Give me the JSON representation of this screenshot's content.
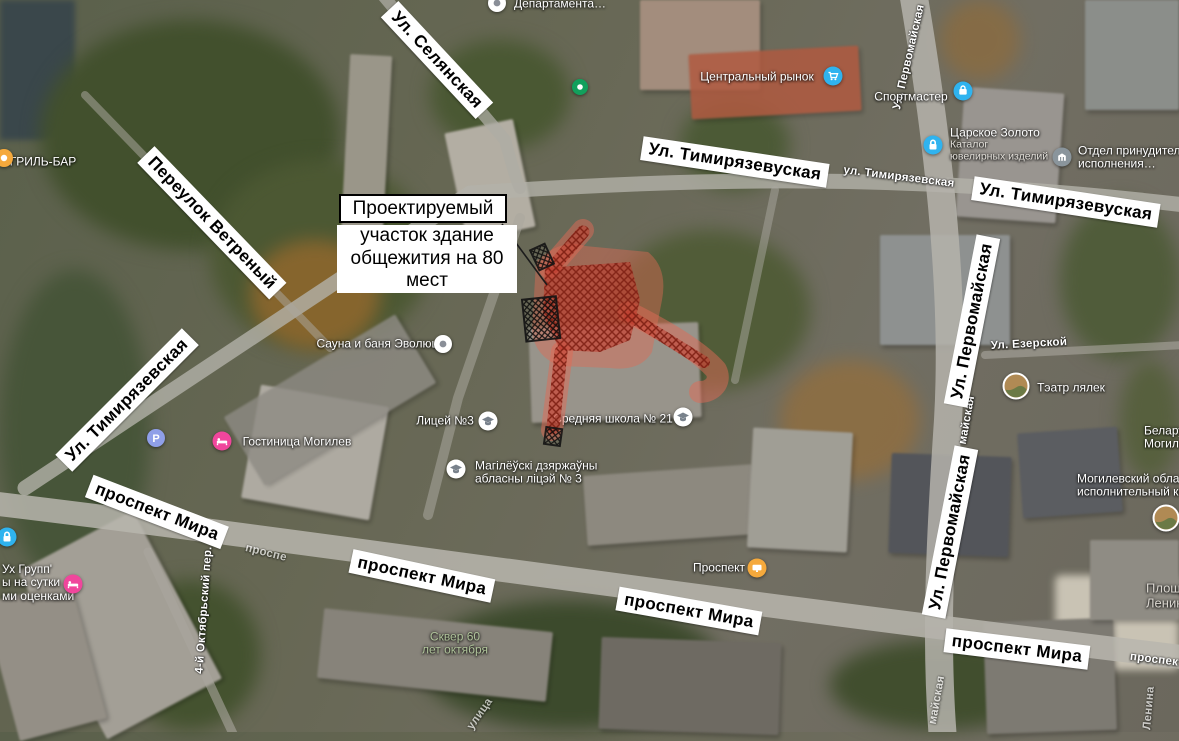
{
  "map": {
    "title": "Схема размещения проектируемого участка",
    "annotation": {
      "lines": [
        "Проектируемый",
        "участок здание",
        "общежития на 80",
        "мест"
      ]
    },
    "colors": {
      "highlight_red": "#c0392b",
      "highlight_halo": "#e06a55",
      "hatch_dark_red": "#7e1f12",
      "hatch_black": "#0d0d0d",
      "poi_blue": "#2fb3ef",
      "poi_pink": "#f0469c",
      "poi_orange": "#f5a93c",
      "poi_green": "#12a05c",
      "poi_gray": "#8a959c",
      "parking_lavender": "#8f9fe8",
      "park_text_green": "#b0c49b",
      "area_text_gray": "#dbd7d0"
    },
    "street_labels_big": [
      {
        "id": "selyanskaya",
        "text": "Ул. Селянская",
        "x": 437,
        "y": 60,
        "rot": 47
      },
      {
        "id": "timiryazevskaya-center",
        "text": "Ул. Тимирязевуская",
        "x": 735,
        "y": 162,
        "rot": 8.5
      },
      {
        "id": "timiryazevskaya-right",
        "text": "Ул. Тимирязевуская",
        "x": 1066,
        "y": 202,
        "rot": 8.5
      },
      {
        "id": "timiryazevskaya-left",
        "text": "Ул. Тимирязевская",
        "x": 127,
        "y": 400,
        "rot": -45
      },
      {
        "id": "pereulok-vetreny",
        "text": "Переулок Ветреный",
        "x": 212,
        "y": 223,
        "rot": 46
      },
      {
        "id": "pervomayskaya-upper",
        "text": "Ул. Первомайская",
        "x": 972,
        "y": 321,
        "rot": -79
      },
      {
        "id": "pervomayskaya-lower",
        "text": "Ул. Первомайская",
        "x": 950,
        "y": 532,
        "rot": -79
      },
      {
        "id": "prospekt-mira-1",
        "text": "проспект Мира",
        "x": 157,
        "y": 512,
        "rot": 21
      },
      {
        "id": "prospekt-mira-2",
        "text": "проспект Мира",
        "x": 422,
        "y": 576,
        "rot": 12
      },
      {
        "id": "prospekt-mira-3",
        "text": "проспект Мира",
        "x": 689,
        "y": 611,
        "rot": 10
      },
      {
        "id": "prospekt-mira-4",
        "text": "проспект Мира",
        "x": 1017,
        "y": 649,
        "rot": 7
      }
    ],
    "street_labels_small": [
      {
        "id": "timiryazevskaya-road",
        "text": "ул. Тимирязевская",
        "x": 899,
        "y": 177,
        "rot": 7
      },
      {
        "id": "pervomayskaya-road-top",
        "text": "Ул. Первомайская",
        "x": 909,
        "y": 57,
        "rot": -77
      },
      {
        "id": "pervomayskaya-road-mid",
        "text": "майская",
        "x": 967,
        "y": 420,
        "rot": -80
      },
      {
        "id": "pervomayskaya-road-bottom",
        "text": "майская",
        "x": 937,
        "y": 700,
        "rot": -80,
        "faint": true
      },
      {
        "id": "oktyabrsky-pereulok",
        "text": "4-й Октябрьский пер.",
        "x": 204,
        "y": 610,
        "rot": -86
      },
      {
        "id": "ezerskoy",
        "text": "Ул. Езерской",
        "x": 1029,
        "y": 344,
        "rot": -3
      },
      {
        "id": "prospekt-road-br",
        "text": "проспект",
        "x": 1157,
        "y": 660,
        "rot": 7
      },
      {
        "id": "lenina-road",
        "text": "Ленина",
        "x": 1149,
        "y": 708,
        "rot": -85,
        "faint": true
      },
      {
        "id": "ulitsa-road",
        "text": "улица",
        "x": 480,
        "y": 714,
        "rot": -55,
        "faint": true
      },
      {
        "id": "prospekt-road-left",
        "text": "проспе",
        "x": 266,
        "y": 553,
        "rot": 14,
        "faint": true
      }
    ],
    "pois": [
      {
        "id": "departamenta",
        "lines": [
          "Департамента…"
        ],
        "x": 560,
        "y": 4,
        "icon": {
          "type": "circle-white",
          "x": 497,
          "y": 3
        }
      },
      {
        "id": "grill-bar",
        "lines": [
          "ГРИЛЬ-БАР"
        ],
        "x": 43,
        "y": 162,
        "icon": {
          "type": "circle-orange",
          "x": 4,
          "y": 158
        }
      },
      {
        "id": "central-market",
        "lines": [
          "Центральный рынок"
        ],
        "x": 757,
        "y": 77,
        "icon": {
          "type": "cart-blue",
          "x": 833,
          "y": 76
        }
      },
      {
        "id": "sportmaster",
        "lines": [
          "Спортмастер"
        ],
        "x": 911,
        "y": 97,
        "icon": {
          "type": "bag-blue",
          "x": 963,
          "y": 91
        }
      },
      {
        "id": "tsarskoe-zoloto",
        "lines": [
          "Царское Золото",
          "Каталог",
          "ювелирных изделий"
        ],
        "x": 950,
        "y": 145,
        "align": "left",
        "sub_after": 0,
        "icon": {
          "type": "lock-blue",
          "x": 933,
          "y": 145
        }
      },
      {
        "id": "otdel-ispolneniya",
        "lines": [
          "Отдел принудитель",
          "исполнения…"
        ],
        "x": 1078,
        "y": 158,
        "align": "left",
        "icon": {
          "type": "building-gray",
          "x": 1062,
          "y": 157
        }
      },
      {
        "id": "sauna-evolution",
        "lines": [
          "Сауна и баня Эволюция"
        ],
        "x": 384,
        "y": 344,
        "icon": {
          "type": "circle-white",
          "x": 443,
          "y": 344
        }
      },
      {
        "id": "litsey-3",
        "lines": [
          "Лицей №3"
        ],
        "x": 445,
        "y": 421,
        "icon": {
          "type": "cap-white",
          "x": 488,
          "y": 421
        }
      },
      {
        "id": "school-21",
        "lines": [
          "Средняя школа № 21"
        ],
        "x": 613,
        "y": 419,
        "icon": {
          "type": "cap-white",
          "x": 683,
          "y": 417
        }
      },
      {
        "id": "oblast-lyceum",
        "lines": [
          "Магілёўскі дзяржаўны",
          "абласны ліцэй № 3"
        ],
        "x": 475,
        "y": 473,
        "align": "left",
        "icon": {
          "type": "cap-white",
          "x": 456,
          "y": 469
        }
      },
      {
        "id": "hotel-mogilev",
        "lines": [
          "Гостиница Могилев"
        ],
        "x": 297,
        "y": 442,
        "icon": {
          "type": "bed-pink",
          "x": 222,
          "y": 441
        }
      },
      {
        "id": "uh-grupp",
        "lines": [
          "Ух Групп'",
          "ы на сутки",
          "ми оценками"
        ],
        "x": 2,
        "y": 583,
        "align": "left",
        "icon": {
          "type": "bed-pink",
          "x": 73,
          "y": 584
        }
      },
      {
        "id": "uh-grupp-marker",
        "lines": [],
        "x": 7,
        "y": 537,
        "icon": {
          "type": "lock-blue",
          "x": 7,
          "y": 537
        }
      },
      {
        "id": "parking",
        "lines": [],
        "x": 156,
        "y": 438,
        "icon": {
          "type": "p-parking",
          "x": 156,
          "y": 438
        }
      },
      {
        "id": "green-marker",
        "lines": [],
        "x": 580,
        "y": 87,
        "icon": {
          "type": "circle-green",
          "x": 580,
          "y": 87
        }
      },
      {
        "id": "prospekt-poi",
        "lines": [
          "Проспект"
        ],
        "x": 719,
        "y": 568,
        "icon": {
          "type": "screen-orange",
          "x": 757,
          "y": 568
        }
      },
      {
        "id": "skver-60-let",
        "lines": [
          "Сквер 60",
          "лет октября"
        ],
        "x": 455,
        "y": 644,
        "color": "#b0c49b"
      },
      {
        "id": "ploshchad-lenina",
        "lines": [
          "Площадь",
          "Ленина"
        ],
        "x": 1146,
        "y": 596,
        "align": "left",
        "color": "#dbd7d0",
        "size": 13
      },
      {
        "id": "teatr-lyalek",
        "lines": [
          "Тэатр лялек"
        ],
        "x": 1071,
        "y": 388,
        "icon": {
          "type": "photo",
          "x": 1016,
          "y": 386
        }
      },
      {
        "id": "belarusbank",
        "lines": [
          "Беларусбанк",
          "Могилев"
        ],
        "x": 1144,
        "y": 438,
        "align": "left"
      },
      {
        "id": "oblispolkom",
        "lines": [
          "Могилевский обла",
          "исполнительный ко"
        ],
        "x": 1077,
        "y": 486,
        "align": "left",
        "icon": {
          "type": "photo",
          "x": 1166,
          "y": 518
        }
      }
    ]
  }
}
